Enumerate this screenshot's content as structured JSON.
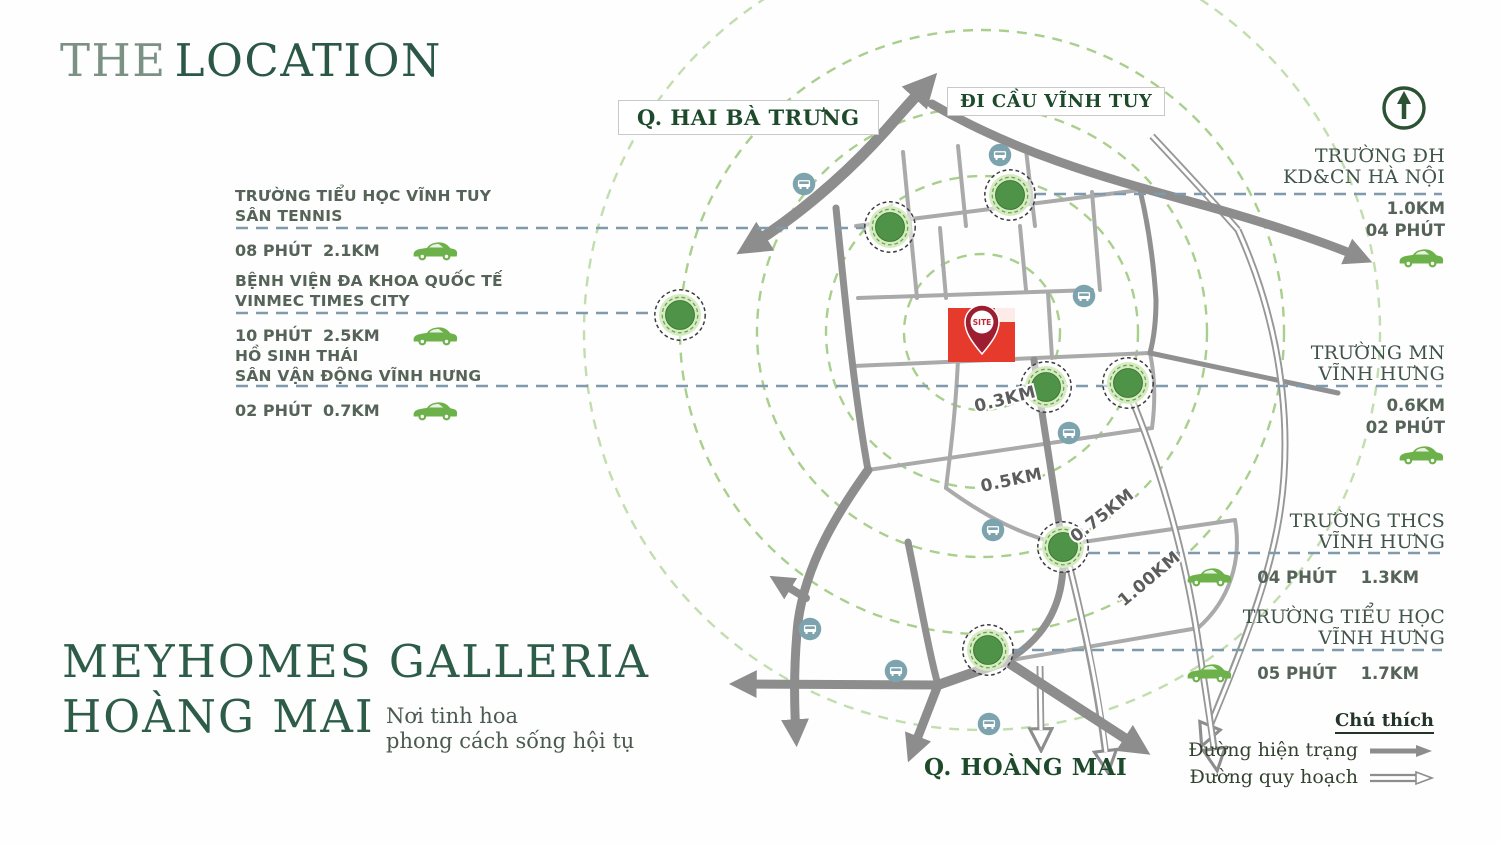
{
  "header": {
    "title_part1": "THE",
    "title_part2": "LOCATION"
  },
  "brand": {
    "line1": "MEYHOMES GALLERIA",
    "line2": "HOÀNG MAI",
    "tagline1": "Nơi tinh hoa",
    "tagline2": "phong cách sống hội tụ"
  },
  "left_pois": [
    {
      "name_line1": "TRƯỜNG TIỂU HỌC VĨNH TUY",
      "name_line2": "SÂN TENNIS",
      "time": "08 PHÚT",
      "distance": "2.1KM"
    },
    {
      "name_line1": "BỆNH VIỆN ĐA KHOA QUỐC TẾ",
      "name_line2": "VINMEC TIMES CITY",
      "time": "10 PHÚT",
      "distance": "2.5KM"
    },
    {
      "name_line1": "HỒ SINH THÁI",
      "name_line2": "SÂN VẬN ĐỘNG VĨNH HƯNG",
      "time": "02 PHÚT",
      "distance": "0.7KM"
    }
  ],
  "right_pois": [
    {
      "name_line1": "TRƯỜNG ĐH",
      "name_line2": "KD&CN HÀ NỘI",
      "distance": "1.0KM",
      "time": "04 PHÚT"
    },
    {
      "name_line1": "TRƯỜNG MN",
      "name_line2": "VĨNH HƯNG",
      "distance": "0.6KM",
      "time": "02 PHÚT"
    },
    {
      "name_line1": "TRƯỜNG THCS",
      "name_line2": "VĨNH HƯNG",
      "time": "04 PHÚT",
      "distance": "1.3KM"
    },
    {
      "name_line1": "TRƯỜNG TIỂU HỌC",
      "name_line2": "VĨNH HƯNG",
      "time": "05 PHÚT",
      "distance": "1.7KM"
    }
  ],
  "map": {
    "labels": {
      "hai_ba_trung": "Q. HAI BÀ TRƯNG",
      "di_cau_vinh_tuy": "ĐI CẦU VĨNH TUY",
      "hoang_mai": "Q. HOÀNG MAI"
    },
    "site_label": "SITE",
    "ring_labels": [
      "0.3KM",
      "0.5KM",
      "0.75KM",
      "1.00KM"
    ]
  },
  "legend": {
    "title": "Chú thích",
    "items": [
      {
        "label": "Đường hiện trạng",
        "type": "solid-arrow"
      },
      {
        "label": "Đường quy hoạch",
        "type": "double-arrow"
      }
    ]
  },
  "colors": {
    "brand_green": "#2d5c49",
    "district_label_green": "#1d4a2a",
    "poi_marker_green": "#4f9348",
    "car_green": "#6db14b",
    "road_gray": "#8d8d8d",
    "site_red": "#e53a2c",
    "pin_red": "#9e1e31",
    "radius_ring_green": "#a8cf8c",
    "bus_icon_blue": "#7da4ae",
    "connector_blue": "#8099ab"
  }
}
